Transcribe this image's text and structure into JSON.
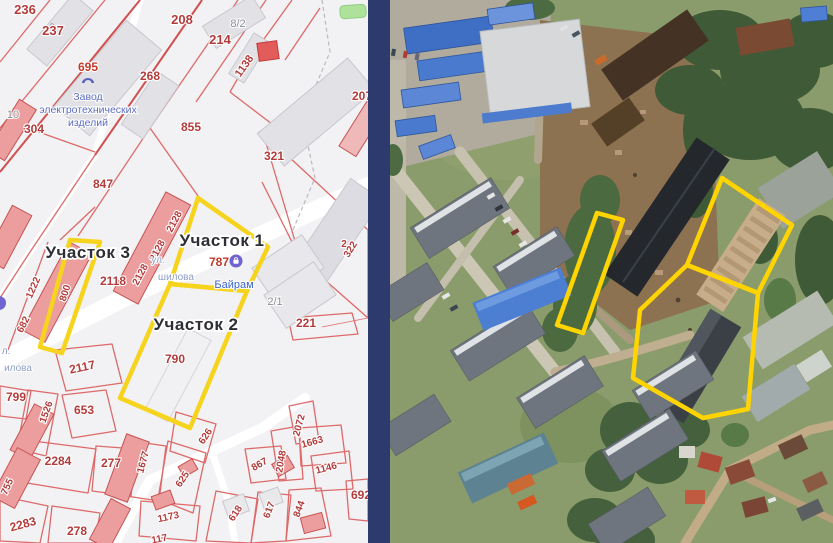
{
  "divider": {
    "color": "#2c3a6d"
  },
  "map": {
    "outline_color": "#f6d31c",
    "colors": {
      "parcel_label": "#b23b3b",
      "parcel_label_gray": "#8b8b92",
      "boundary_line": "#dd6a6a"
    },
    "plot_labels": [
      {
        "text": "Участок 3",
        "x": 88,
        "y": 258
      },
      {
        "text": "Участок 1",
        "x": 222,
        "y": 246
      },
      {
        "text": "Участок 2",
        "x": 196,
        "y": 330
      }
    ],
    "plots": [
      {
        "name": "plot-1",
        "points": "198,198 268,247 247,291 170,284"
      },
      {
        "name": "plot-2",
        "points": "170,284 247,291 190,428 120,398"
      },
      {
        "name": "plot-3",
        "points": "70,240 100,242 62,353 40,347"
      }
    ],
    "parcels": [
      {
        "t": "236",
        "x": 25,
        "y": 14,
        "r": 0,
        "s": 13
      },
      {
        "t": "237",
        "x": 53,
        "y": 35,
        "r": 0,
        "s": 13
      },
      {
        "t": "208",
        "x": 182,
        "y": 24,
        "r": 0,
        "s": 13
      },
      {
        "t": "214",
        "x": 220,
        "y": 44,
        "r": 0,
        "s": 13
      },
      {
        "t": "8/2",
        "x": 238,
        "y": 27,
        "r": 0,
        "s": 11,
        "g": true
      },
      {
        "t": "1138",
        "x": 247,
        "y": 68,
        "r": -55,
        "s": 11
      },
      {
        "t": "268",
        "x": 150,
        "y": 80,
        "r": 0,
        "s": 12
      },
      {
        "t": "855",
        "x": 191,
        "y": 131,
        "r": 0,
        "s": 12
      },
      {
        "t": "304",
        "x": 34,
        "y": 133,
        "r": 0,
        "s": 12
      },
      {
        "t": "10",
        "x": 13,
        "y": 118,
        "r": 0,
        "s": 11,
        "g": true
      },
      {
        "t": "321",
        "x": 274,
        "y": 160,
        "r": 0,
        "s": 12
      },
      {
        "t": "207",
        "x": 362,
        "y": 100,
        "r": 0,
        "s": 12
      },
      {
        "t": "847",
        "x": 103,
        "y": 188,
        "r": 0,
        "s": 12
      },
      {
        "t": "2118",
        "x": 113,
        "y": 285,
        "r": 0,
        "s": 12
      },
      {
        "t": "2128",
        "x": 143,
        "y": 276,
        "r": -62,
        "s": 10
      },
      {
        "t": "2128",
        "x": 160,
        "y": 252,
        "r": -62,
        "s": 10
      },
      {
        "t": "2128",
        "x": 177,
        "y": 223,
        "r": -62,
        "s": 10
      },
      {
        "t": "800",
        "x": 68,
        "y": 294,
        "r": -72,
        "s": 10
      },
      {
        "t": "1222",
        "x": 36,
        "y": 289,
        "r": -66,
        "s": 10
      },
      {
        "t": "682",
        "x": 26,
        "y": 326,
        "r": -62,
        "s": 10
      },
      {
        "t": "2117",
        "x": 83,
        "y": 371,
        "r": -12,
        "s": 12
      },
      {
        "t": "790",
        "x": 175,
        "y": 363,
        "r": 0,
        "s": 12
      },
      {
        "t": "221",
        "x": 306,
        "y": 327,
        "r": 0,
        "s": 12
      },
      {
        "t": "2/1",
        "x": 275,
        "y": 305,
        "r": 0,
        "s": 11,
        "g": true
      },
      {
        "t": "2",
        "x": 344,
        "y": 247,
        "r": 0,
        "s": 10
      },
      {
        "t": "322",
        "x": 353,
        "y": 251,
        "r": -58,
        "s": 10
      },
      {
        "t": "2072",
        "x": 302,
        "y": 426,
        "r": -75,
        "s": 10
      },
      {
        "t": "1663",
        "x": 313,
        "y": 445,
        "r": -15,
        "s": 10
      },
      {
        "t": "2048",
        "x": 284,
        "y": 462,
        "r": -80,
        "s": 10
      },
      {
        "t": "1146",
        "x": 327,
        "y": 471,
        "r": -15,
        "s": 10
      },
      {
        "t": "867",
        "x": 261,
        "y": 467,
        "r": -30,
        "s": 10
      },
      {
        "t": "626",
        "x": 208,
        "y": 438,
        "r": -56,
        "s": 10
      },
      {
        "t": "625",
        "x": 185,
        "y": 481,
        "r": -56,
        "s": 10
      },
      {
        "t": "2284",
        "x": 58,
        "y": 465,
        "r": 0,
        "s": 12
      },
      {
        "t": "277",
        "x": 111,
        "y": 467,
        "r": 0,
        "s": 12
      },
      {
        "t": "1677",
        "x": 146,
        "y": 463,
        "r": -75,
        "s": 10
      },
      {
        "t": "1526",
        "x": 49,
        "y": 413,
        "r": -70,
        "s": 10
      },
      {
        "t": "653",
        "x": 84,
        "y": 414,
        "r": 0,
        "s": 12
      },
      {
        "t": "799",
        "x": 16,
        "y": 401,
        "r": 0,
        "s": 12
      },
      {
        "t": "755",
        "x": 10,
        "y": 488,
        "r": -65,
        "s": 10
      },
      {
        "t": "2283",
        "x": 24,
        "y": 528,
        "r": -15,
        "s": 12
      },
      {
        "t": "278",
        "x": 77,
        "y": 535,
        "r": 0,
        "s": 12
      },
      {
        "t": "1173",
        "x": 169,
        "y": 520,
        "r": -12,
        "s": 10
      },
      {
        "t": "117",
        "x": 160,
        "y": 542,
        "r": -12,
        "s": 10
      },
      {
        "t": "618",
        "x": 238,
        "y": 515,
        "r": -56,
        "s": 10
      },
      {
        "t": "617",
        "x": 272,
        "y": 511,
        "r": -70,
        "s": 10
      },
      {
        "t": "844",
        "x": 302,
        "y": 510,
        "r": -70,
        "s": 10
      },
      {
        "t": "692",
        "x": 361,
        "y": 499,
        "r": 0,
        "s": 12
      }
    ],
    "streets": [
      {
        "text": "ул.",
        "x": 158,
        "y": 263
      },
      {
        "text": "шилова",
        "x": 176,
        "y": 280
      },
      {
        "text": "л.",
        "x": 6,
        "y": 354
      },
      {
        "text": "илова",
        "x": 18,
        "y": 371
      }
    ],
    "factory_poi": {
      "number": "695",
      "x": 88,
      "number_y": 71,
      "icon_y": 81,
      "lines": [
        "Завод",
        "электротехнических",
        "изделий"
      ],
      "line_ys": [
        100,
        113,
        126
      ]
    },
    "bayram_poi": {
      "number": "787",
      "number_x": 219,
      "number_y": 266,
      "icon_x": 236,
      "icon_y": 261,
      "name": "Байрам",
      "name_x": 234,
      "name_y": 288
    }
  },
  "satellite": {
    "outline_color": "#ffd400",
    "plots": [
      {
        "name": "plot-1",
        "points": "332,178 402,225 368,293 297,265"
      },
      {
        "name": "plot-2",
        "points": "297,265 368,293 358,409 313,418 243,378 250,310"
      },
      {
        "name": "plot-3",
        "points": "207,213 233,220 193,333 167,325"
      }
    ]
  }
}
